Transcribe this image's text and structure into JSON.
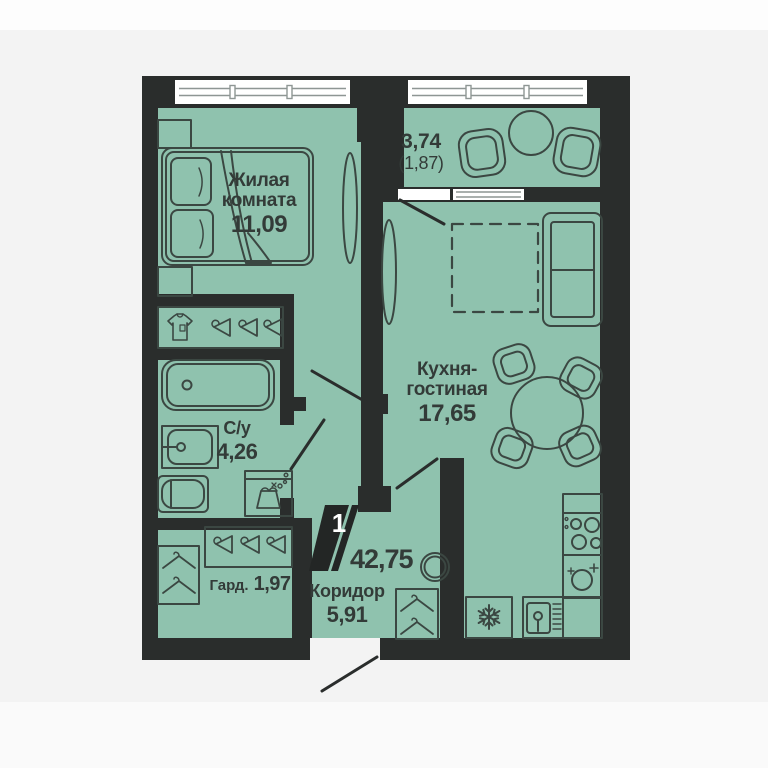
{
  "plan": {
    "badge": {
      "rooms_count": "1"
    },
    "summary": {
      "total_area": "42,75"
    },
    "rooms": {
      "living": {
        "name_line1": "Жилая",
        "name_line2": "комната",
        "area": "11,09"
      },
      "balcony": {
        "area": "3,74",
        "area_coefficient": "(1,87)"
      },
      "kitchen": {
        "name_line1": "Кухня-",
        "name_line2": "гостиная",
        "area": "17,65"
      },
      "bathroom": {
        "name": "С/у",
        "area": "4,26"
      },
      "wardrobe": {
        "name": "Гард.",
        "area": "1,97"
      },
      "corridor": {
        "name": "Коридор",
        "area": "5,91"
      }
    },
    "colors": {
      "walls": "#2a2d2c",
      "floor": "#8fc2ae",
      "background": "#f3f3f3",
      "furniture_stroke": "#3b4742",
      "text": "#333b38",
      "badge_bg": "#232625",
      "badge_text": "#ffffff",
      "window_fill": "#ffffff",
      "window_frame": "#8e9694"
    },
    "icons": [
      "bed-icon",
      "nightstand-icon",
      "pillow-icon",
      "shirt-icon",
      "hanger-icon",
      "bathtub-icon",
      "sink-icon",
      "toilet-icon",
      "washing-machine-icon",
      "laundry-basket-icon",
      "mirror-icon",
      "snowflake-icon",
      "kitchen-sink-icon",
      "stove-icon",
      "dishwasher-icon",
      "sofa-icon",
      "dining-table-icon",
      "chair-icon",
      "armchair-icon",
      "coffee-table-icon",
      "door-swing-icon",
      "window-icon"
    ]
  }
}
